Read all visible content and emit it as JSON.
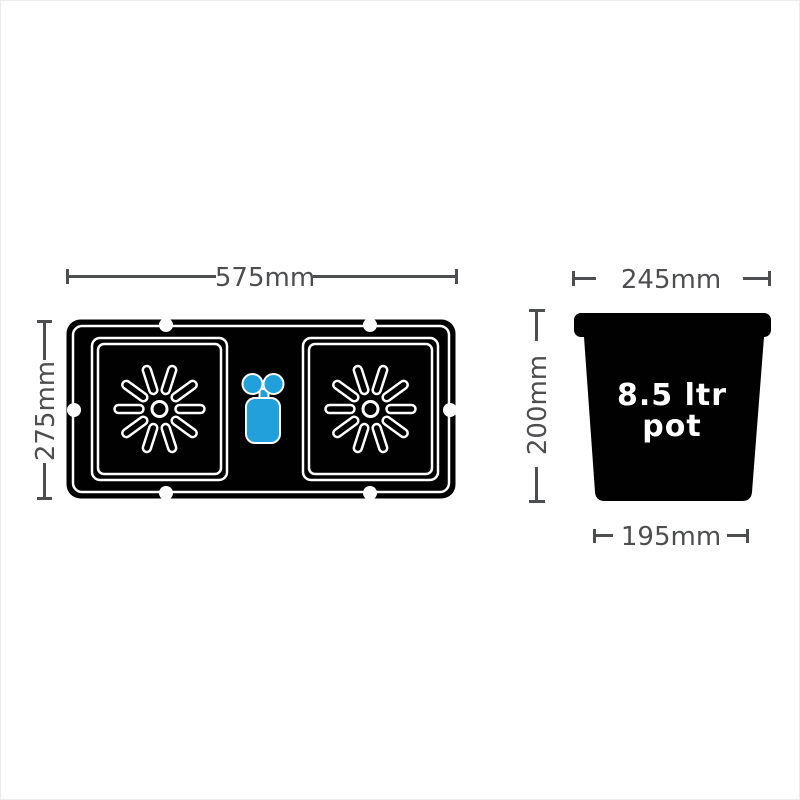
{
  "colors": {
    "shape_black": "#010101",
    "outline_white": "#ffffff",
    "valve_blue": "#21A0DC",
    "dimension_gray": "#4d4e50",
    "page_background": "#ffffff",
    "page_border": "#ececec"
  },
  "icons": {
    "tray_outline": "tray-top-view-icon",
    "pot_station": "pot-station-starburst-icon",
    "float_valve": "float-valve-icon",
    "tray_hole": "tray-hole-dot-icon",
    "pot_outline": "pot-front-view-icon"
  },
  "tray_diagram": {
    "width_dimension": "575mm",
    "height_dimension": "275mm"
  },
  "pot_diagram": {
    "top_width_dimension": "245mm",
    "height_dimension": "200mm",
    "base_width_dimension": "195mm",
    "label_line1": "8.5 ltr",
    "label_line2": "pot"
  }
}
